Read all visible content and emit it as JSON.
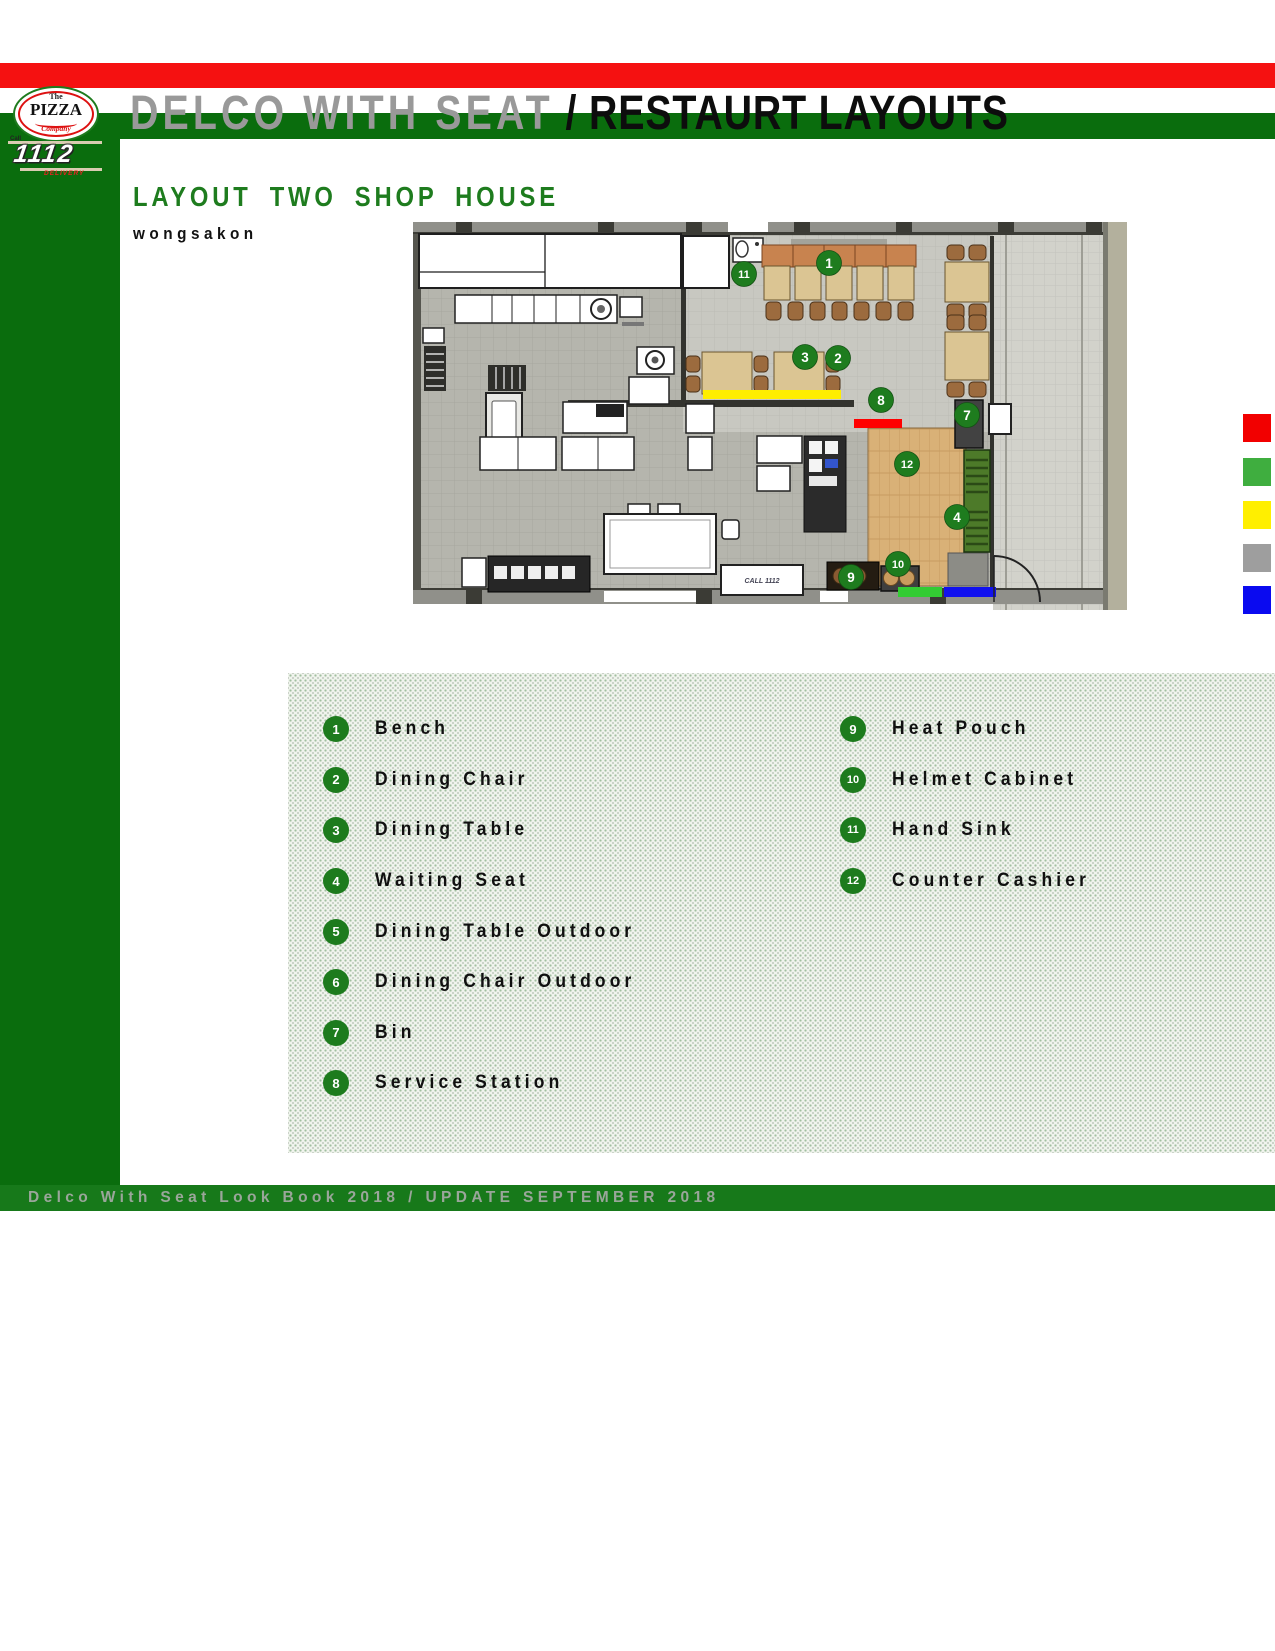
{
  "page": {
    "title_gray": "DELCO WITH SEAT",
    "title_black": " / RESTAURT LAYOUTS",
    "section_title": "LAYOUT TWO SHOP HOUSE",
    "author": "wongsakon",
    "footer": "Delco With Seat Look Book 2018 / UPDATE SEPTEMBER 2018"
  },
  "logo": {
    "brand_top": "The",
    "brand_main": "PIZZA",
    "brand_sub": "Company",
    "phone_call": "Call",
    "phone_number": "1112",
    "phone_caption": "DELIVERY"
  },
  "colors": {
    "stripe_red": "#f51111",
    "stripe_green": "#0a6d0d",
    "sidebar_green": "#0a6d0d",
    "footer_green": "#17791a",
    "heading_green": "#1e7c1e",
    "marker_green": "#1e7c1e",
    "accent_yellow": "#ffee00",
    "accent_red": "#ff0000",
    "accent_green": "#33cc33",
    "accent_blue": "#1111ee"
  },
  "swatches": [
    {
      "name": "red",
      "color": "#f20000",
      "top": 414
    },
    {
      "name": "green",
      "color": "#3fae3f",
      "top": 458
    },
    {
      "name": "yellow",
      "color": "#ffef00",
      "top": 501
    },
    {
      "name": "gray",
      "color": "#9e9e9e",
      "top": 544
    },
    {
      "name": "blue",
      "color": "#0a0af0",
      "top": 586
    }
  ],
  "legend": {
    "columns": [
      [
        {
          "num": "1",
          "label": "Bench"
        },
        {
          "num": "2",
          "label": "Dining Chair"
        },
        {
          "num": "3",
          "label": "Dining Table"
        },
        {
          "num": "4",
          "label": "Waiting Seat"
        },
        {
          "num": "5",
          "label": "Dining Table Outdoor"
        },
        {
          "num": "6",
          "label": "Dining Chair Outdoor"
        },
        {
          "num": "7",
          "label": "Bin"
        },
        {
          "num": "8",
          "label": "Service Station"
        }
      ],
      [
        {
          "num": "9",
          "label": "Heat Pouch"
        },
        {
          "num": "10",
          "label": "Helmet Cabinet"
        },
        {
          "num": "11",
          "label": "Hand Sink"
        },
        {
          "num": "12",
          "label": "Counter Cashier"
        }
      ]
    ]
  },
  "plan": {
    "call_box_label": "CALL 1112",
    "markers": [
      {
        "num": "1",
        "x": 829,
        "y": 263
      },
      {
        "num": "2",
        "x": 838,
        "y": 358
      },
      {
        "num": "3",
        "x": 805,
        "y": 357
      },
      {
        "num": "4",
        "x": 957,
        "y": 517
      },
      {
        "num": "7",
        "x": 967,
        "y": 415
      },
      {
        "num": "8",
        "x": 881,
        "y": 400
      },
      {
        "num": "9",
        "x": 851,
        "y": 577
      },
      {
        "num": "10",
        "x": 898,
        "y": 564
      },
      {
        "num": "11",
        "x": 744,
        "y": 274
      },
      {
        "num": "12",
        "x": 907,
        "y": 464
      }
    ]
  }
}
